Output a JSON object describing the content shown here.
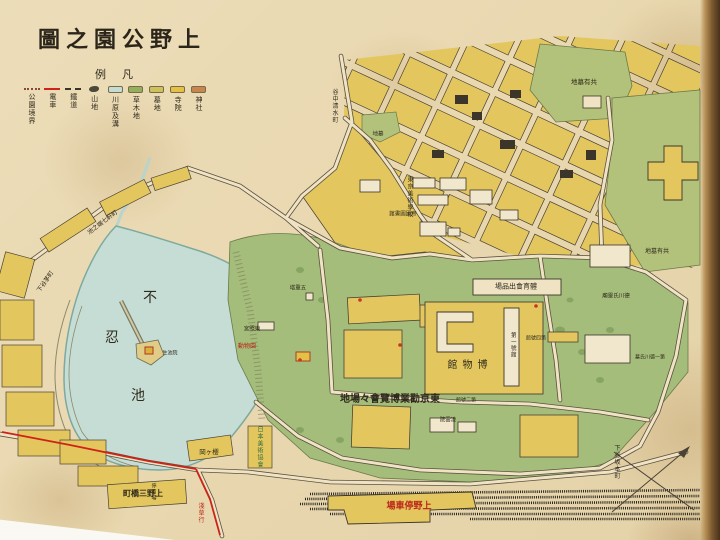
{
  "palette": {
    "paper": "#e9d8b0",
    "water": "#c5ddd5",
    "water_edge": "#7ea99e",
    "park_green": "#a4bd7a",
    "cemetery_green": "#b3c27b",
    "block_yellow": "#e3c75e",
    "road_light": "#efe3c4",
    "road_dark": "#5a5140",
    "rail_black": "#2c2820",
    "tram_red": "#cf2318",
    "label_dark": "#2f2a1c",
    "label_red": "#bc2418",
    "label_green": "#2e6b40"
  },
  "title": {
    "display": "圖之園公野上"
  },
  "legend": {
    "header": "例凡",
    "items": [
      {
        "label": "公園境界",
        "swatch": "dashdot",
        "color": "#8a4a2e"
      },
      {
        "label": "電車",
        "swatch": "line-red",
        "color": "#cf2318"
      },
      {
        "label": "鐵道",
        "swatch": "dash",
        "color": "#3a352a"
      },
      {
        "label": "山地",
        "swatch": "glyph",
        "color": "#4b4a38"
      },
      {
        "label": "川原及溝",
        "swatch": "pill",
        "color": "#c3dcd4"
      },
      {
        "label": "草木地",
        "swatch": "pill",
        "color": "#93b05e"
      },
      {
        "label": "墓地",
        "swatch": "pill",
        "color": "#cdc15e"
      },
      {
        "label": "寺院",
        "swatch": "pill",
        "color": "#e4c045"
      },
      {
        "label": "神社",
        "swatch": "pill",
        "color": "#c9854f"
      }
    ]
  },
  "map_labels": [
    {
      "id": "pond-fu",
      "t": "不",
      "x": 150,
      "y": 298,
      "s": 14
    },
    {
      "id": "pond-shinobu",
      "t": "忍",
      "x": 112,
      "y": 338,
      "s": 14
    },
    {
      "id": "pond-ike",
      "t": "池",
      "x": 138,
      "y": 396,
      "s": 14
    },
    {
      "id": "seichiin",
      "t": "生池院",
      "x": 170,
      "y": 354,
      "s": 5
    },
    {
      "id": "zoo",
      "t": "動物園",
      "x": 247,
      "y": 347,
      "s": 6,
      "c": "red"
    },
    {
      "id": "toshogu",
      "t": "宮照東",
      "x": 252,
      "y": 330,
      "s": 5.5
    },
    {
      "id": "pagoda",
      "t": "塔重五",
      "x": 298,
      "y": 289,
      "s": 5.5
    },
    {
      "id": "art-school",
      "t": "東京美術學校",
      "x": 409,
      "y": 197,
      "s": 6,
      "v": 1
    },
    {
      "id": "imperial-library",
      "t": "館書圖國帝",
      "x": 403,
      "y": 215,
      "s": 5.5
    },
    {
      "id": "taiiku-exhibit",
      "t": "場品出會育體",
      "x": 516,
      "y": 287,
      "s": 7
    },
    {
      "id": "museum",
      "t": "館物博",
      "x": 470,
      "y": 366,
      "s": 10,
      "sp": 5
    },
    {
      "id": "bldg-1",
      "t": "第一號館",
      "x": 512,
      "y": 345,
      "s": 5.5,
      "v": 1
    },
    {
      "id": "bldg-2",
      "t": "館號二第",
      "x": 466,
      "y": 401,
      "s": 5
    },
    {
      "id": "bldg-4",
      "t": "館號四第",
      "x": 536,
      "y": 339,
      "s": 5
    },
    {
      "id": "expo-grounds",
      "t": "地場々會覽博業勸京東",
      "x": 390,
      "y": 400,
      "s": 10,
      "b": 1
    },
    {
      "id": "ryounin",
      "t": "院雲凌",
      "x": 448,
      "y": 421,
      "s": 5.5
    },
    {
      "id": "tokugawa-mausoleum",
      "t": "廟靈氏川德",
      "x": 616,
      "y": 297,
      "s": 5.5
    },
    {
      "id": "tokugawa-tomb",
      "t": "墓氏川德一第",
      "x": 650,
      "y": 358,
      "s": 5
    },
    {
      "id": "cemetery-a",
      "t": "地墓有共",
      "x": 584,
      "y": 82,
      "s": 6.5
    },
    {
      "id": "cemetery-b",
      "t": "地墓有共",
      "x": 657,
      "y": 252,
      "s": 6
    },
    {
      "id": "bochi-patch",
      "t": "地墓",
      "x": 378,
      "y": 135,
      "s": 5.5
    },
    {
      "id": "yanaka-shimizu",
      "t": "谷中清水町",
      "x": 334,
      "y": 106,
      "s": 6,
      "v": 1
    },
    {
      "id": "ikenohata-street",
      "t": "池之端七軒町",
      "x": 103,
      "y": 223,
      "s": 6,
      "r": -37
    },
    {
      "id": "shitaya-kaya",
      "t": "下谷茅町",
      "x": 46,
      "y": 282,
      "s": 6,
      "r": -55
    },
    {
      "id": "mihashi-town",
      "t": "町橋三野上",
      "x": 143,
      "y": 493,
      "s": 8,
      "b": 1
    },
    {
      "id": "ueno-station",
      "t": "場車停野上",
      "x": 409,
      "y": 507,
      "s": 9,
      "c": "red",
      "b": 1
    },
    {
      "id": "asakusa-bound",
      "t": "淺草行",
      "x": 200,
      "y": 513,
      "s": 6,
      "v": 1,
      "c": "red"
    },
    {
      "id": "tram-stop",
      "t": "停留場",
      "x": 153,
      "y": 492,
      "s": 5,
      "v": 1
    },
    {
      "id": "art-association",
      "t": "日本美術協會",
      "x": 259,
      "y": 447,
      "s": 6,
      "v": 1,
      "c": "green"
    },
    {
      "id": "sakamoto-town",
      "t": "下谷坂本町",
      "x": 616,
      "y": 462,
      "s": 6,
      "v": 1
    },
    {
      "id": "sakuragaoka",
      "t": "岡ヶ櫻",
      "x": 209,
      "y": 452,
      "s": 6.5
    }
  ]
}
